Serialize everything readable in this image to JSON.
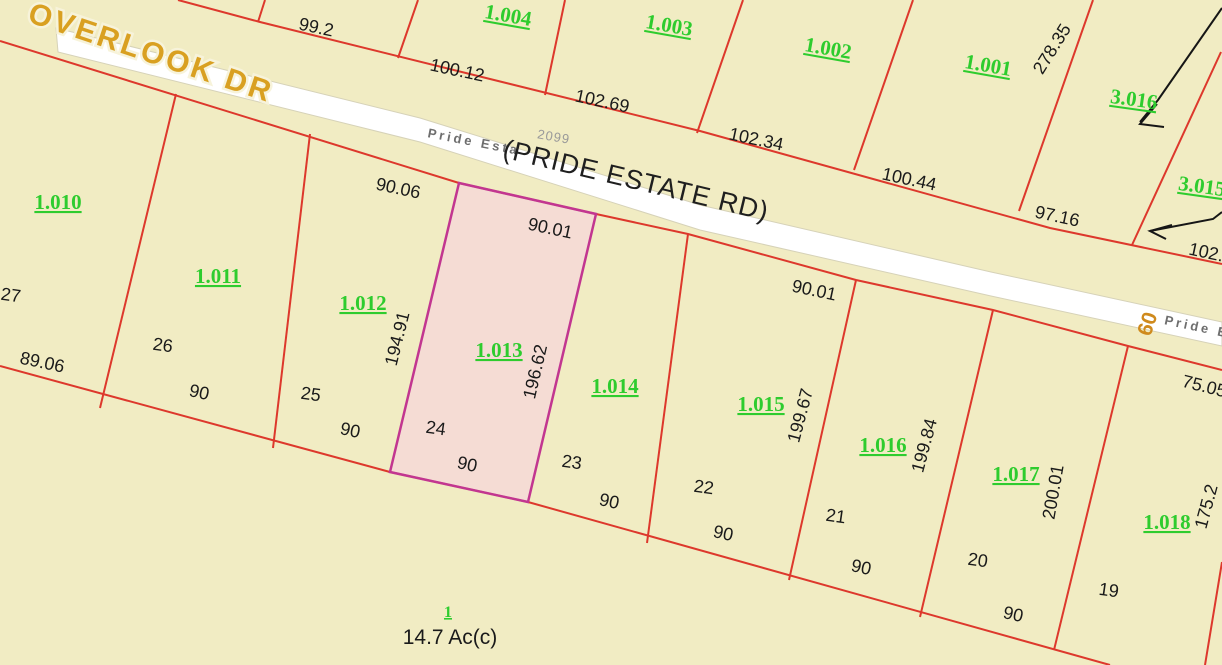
{
  "map": {
    "type": "parcel-plat-map",
    "roads": {
      "overlook": {
        "name": "OVERLOOK DR"
      },
      "pride_estate": {
        "primary_label": "(PRIDE ESTATE RD)",
        "street_label": "Pride Esta",
        "street_label_right": "Pride E",
        "address_number": "2099",
        "right_of_way_width": "60"
      }
    },
    "highlighted_parcel": {
      "id": "1.013",
      "lot_number": "24",
      "frontage_road": "90.01",
      "side_west": "194.91",
      "side_east": "196.62",
      "rear_width": "90"
    },
    "parcel_ids": [
      "1.004",
      "1.003",
      "1.002",
      "1.001",
      "3.016",
      "3.015",
      "1.010",
      "1.011",
      "1.012",
      "1.013",
      "1.014",
      "1.015",
      "1.016",
      "1.017",
      "1.018"
    ],
    "lot_numbers": [
      "27",
      "26",
      "25",
      "24",
      "23",
      "22",
      "21",
      "20",
      "19"
    ],
    "dimensions": [
      "99.2",
      "100.12",
      "102.69",
      "102.34",
      "100.44",
      "97.16",
      "278.35",
      "102.",
      "75.05",
      "90.06",
      "90.01",
      "90.01",
      "194.91",
      "196.62",
      "199.67",
      "199.84",
      "200.01",
      "175.2",
      "89.06",
      "90",
      "90",
      "90",
      "90",
      "90",
      "90",
      "90"
    ],
    "acreage_label": {
      "lot": "1",
      "area": "14.7 Ac(c)"
    },
    "colors": {
      "background": "#f1ecc3",
      "parcel_line": "#dd382c",
      "road_fill": "#ffffff",
      "highlight_border": "#c23690",
      "highlight_fill": "#f5dcd4",
      "parcel_id_text": "#2ecc2e",
      "dimension_text": "#1a1a1a",
      "road_name_text": "#d9a021",
      "road_minor_text": "#6e6e6e"
    }
  }
}
